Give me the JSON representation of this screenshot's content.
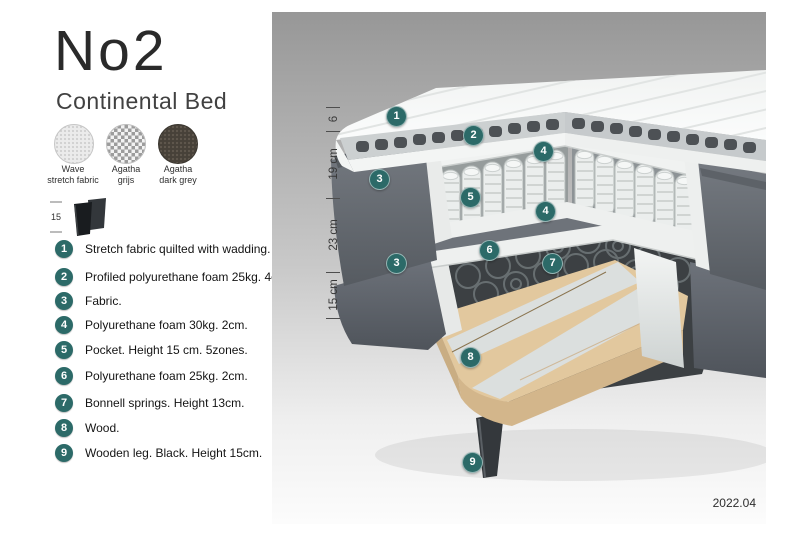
{
  "header": {
    "title": "No2",
    "subtitle": "Continental Bed"
  },
  "swatches": [
    {
      "name": "wave-stretch-fabric",
      "line1": "Wave",
      "line2": "stretch fabric"
    },
    {
      "name": "agatha-grijs",
      "line1": "Agatha",
      "line2": "grijs"
    },
    {
      "name": "agatha-dark-grey",
      "line1": "Agatha",
      "line2": "dark grey"
    }
  ],
  "leg_icon": {
    "height_label": "15"
  },
  "legend": [
    {
      "num": "1",
      "text": "Stretch fabric quilted with wadding."
    },
    {
      "num": "2",
      "text": "Profiled polyurethane foam 25kg. 4cm."
    },
    {
      "num": "3",
      "text": "Fabric."
    },
    {
      "num": "4",
      "text": "Polyurethane foam 30kg. 2cm."
    },
    {
      "num": "5",
      "text": "Pocket. Height 15 cm. 5zones."
    },
    {
      "num": "6",
      "text": "Polyurethane foam 25kg. 2cm."
    },
    {
      "num": "7",
      "text": "Bonnell springs. Height 13cm."
    },
    {
      "num": "8",
      "text": "Wood."
    },
    {
      "num": "9",
      "text": "Wooden leg. Black. Height 15cm."
    }
  ],
  "diagram": {
    "dimensions": [
      {
        "label": "6"
      },
      {
        "label": "19 cm"
      },
      {
        "label": "23 cm"
      },
      {
        "label": "15 cm"
      }
    ],
    "callouts": [
      {
        "num": "1"
      },
      {
        "num": "2"
      },
      {
        "num": "4"
      },
      {
        "num": "3"
      },
      {
        "num": "5"
      },
      {
        "num": "4"
      },
      {
        "num": "6"
      },
      {
        "num": "3"
      },
      {
        "num": "7"
      },
      {
        "num": "8"
      },
      {
        "num": "9"
      }
    ]
  },
  "footer": {
    "version": "2022.04"
  },
  "colors": {
    "badge_teal": "#2c6a68",
    "fabric_grey": "#6b7077",
    "wood": "#e2c89e"
  }
}
